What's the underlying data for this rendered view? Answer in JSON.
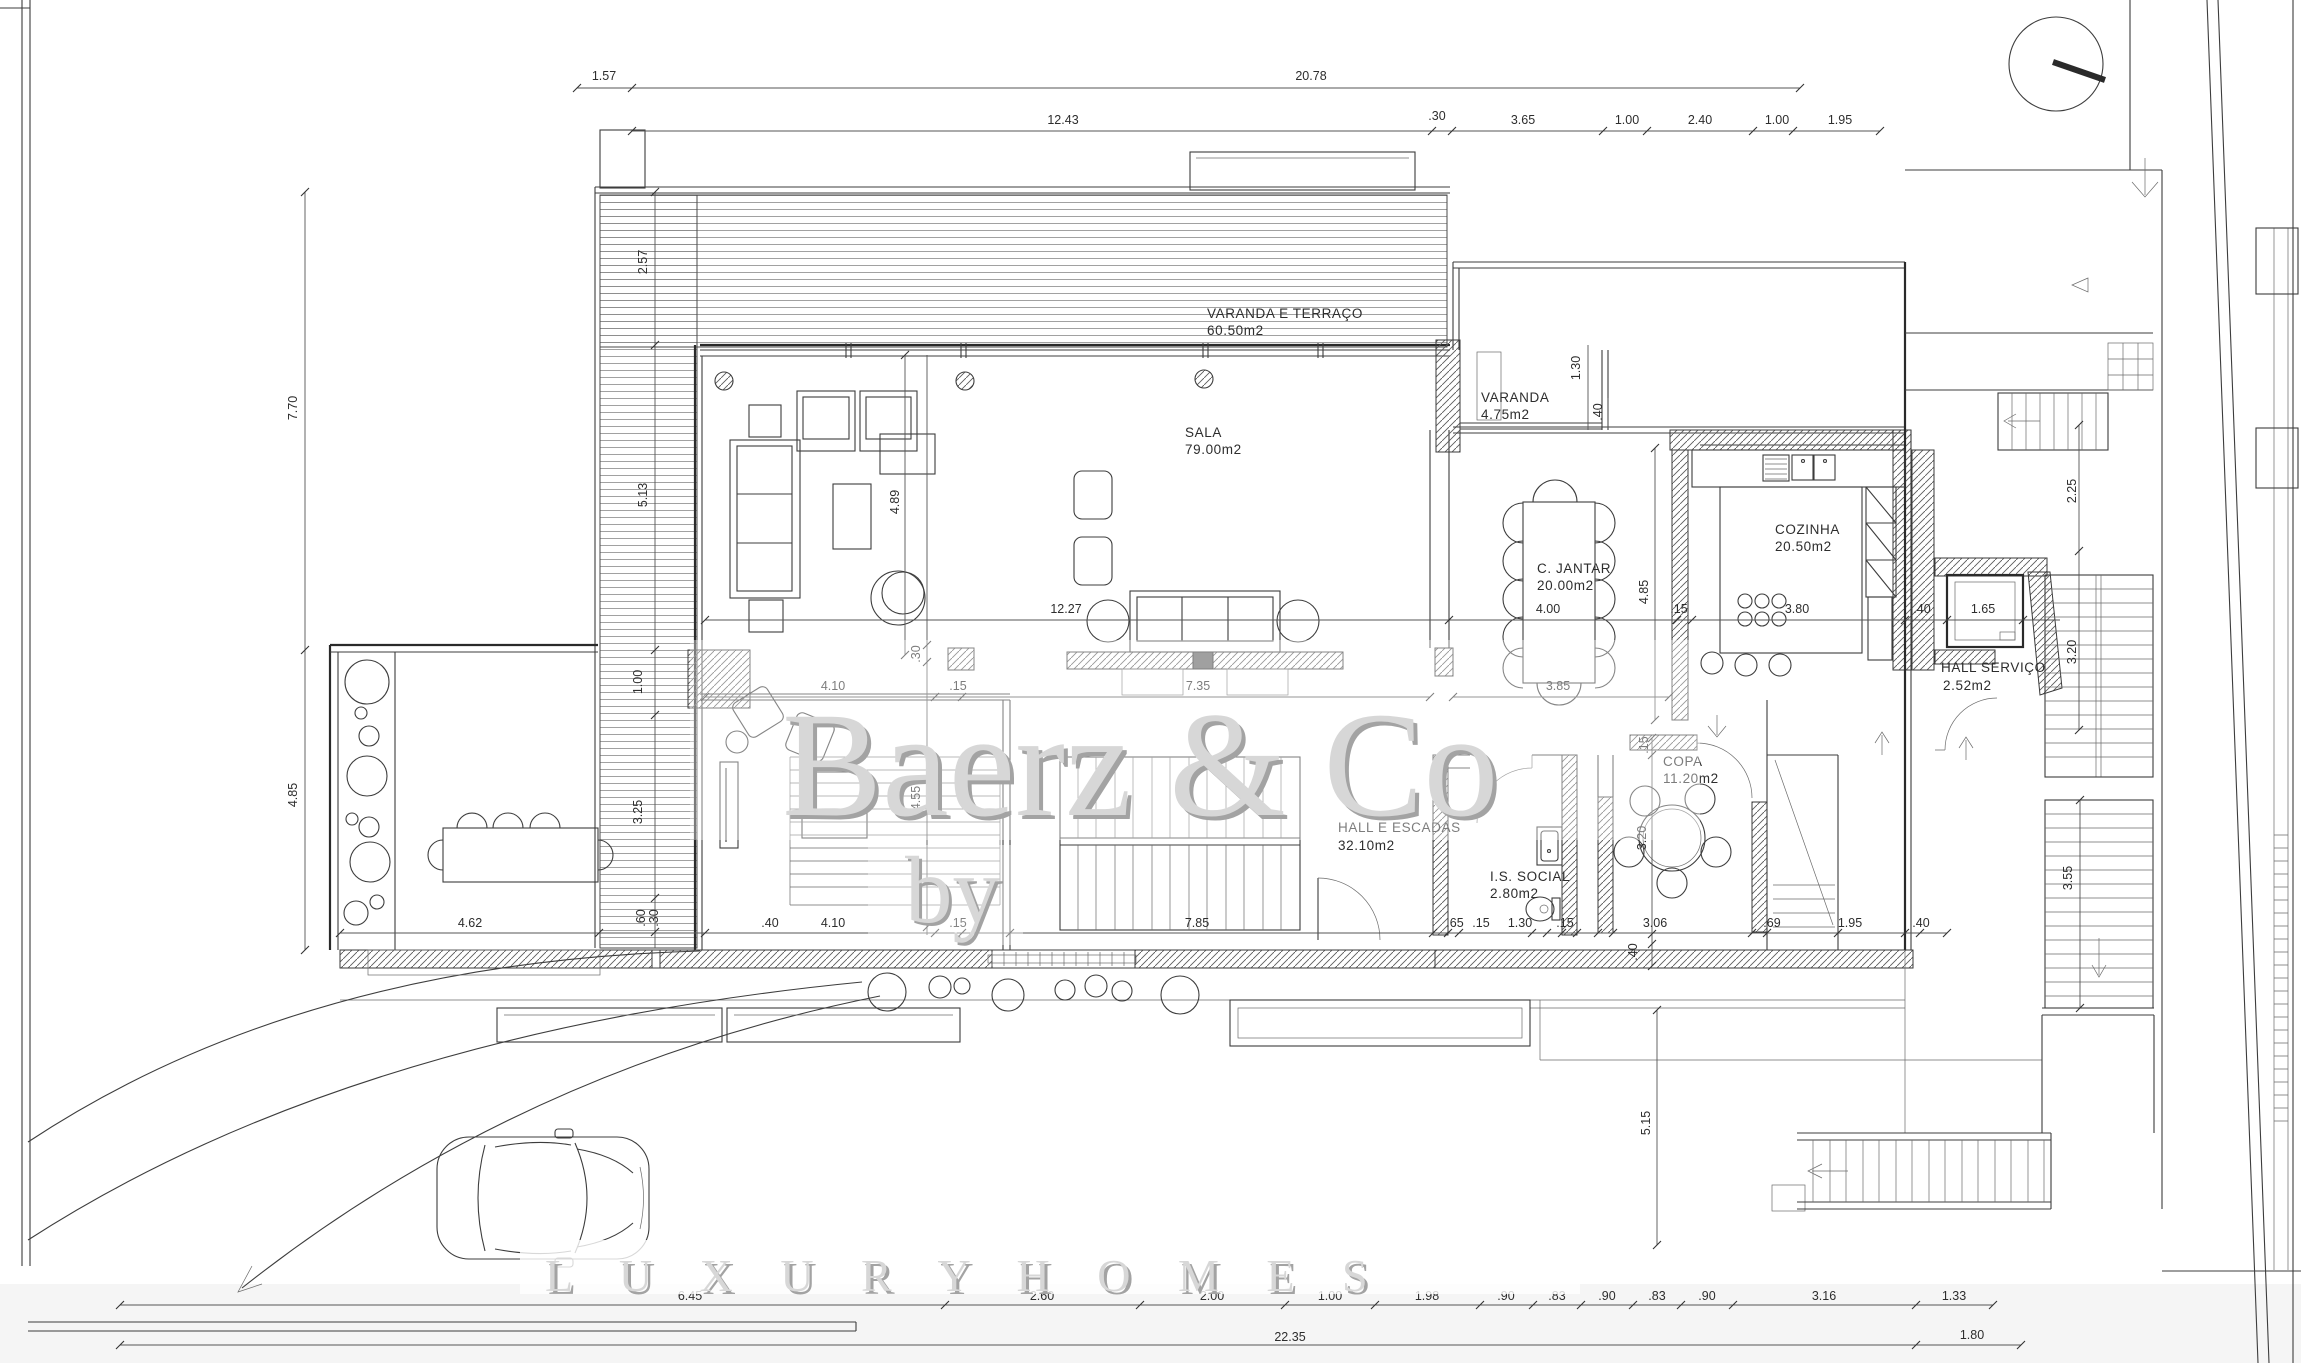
{
  "watermark": {
    "by": "by",
    "brand": "Baerz & Co",
    "tagline": "L U X U R Y   H O M E S"
  },
  "rooms": {
    "terrace": {
      "name": "VARANDA E TERRAÇO",
      "area": "60.50m2"
    },
    "sala": {
      "name": "SALA",
      "area": "79.00m2"
    },
    "varanda": {
      "name": "VARANDA",
      "area": "4.75m2"
    },
    "cozinha": {
      "name": "COZINHA",
      "area": "20.50m2"
    },
    "jantar": {
      "name": "C. JANTAR",
      "area": "20.00m2"
    },
    "copa": {
      "name": "COPA",
      "area": "11.20m2"
    },
    "is_social": {
      "name": "I.S. SOCIAL",
      "area": "2.80m2"
    },
    "hall": {
      "name": "HALL E ESCADAS",
      "area": "32.10m2"
    },
    "hall_servico": {
      "name": "HALL SERVIÇO",
      "area": "2.52m2"
    }
  },
  "dims": [
    "1.57",
    "20.78",
    "12.43",
    ".30",
    "3.65",
    "1.00",
    "2.40",
    "1.00",
    "1.95",
    "7.70",
    "4.85",
    "2.57",
    "5.13",
    "1.00",
    "3.25",
    ".60",
    ".30",
    "4.89",
    ".30",
    "4.55",
    "12.27",
    "4.00",
    ".15",
    "3.80",
    ".40",
    "1.65",
    "4.10",
    ".15",
    "7.35",
    "3.85",
    "4.85",
    "1.30",
    "2.25",
    "3.20",
    "3.20",
    ".15",
    ".40",
    "4.62",
    ".40",
    "4.10",
    ".15",
    "7.85",
    ".65",
    ".15",
    "1.30",
    ".15",
    "3.06",
    ".69",
    "1.95",
    ".40",
    "3.55",
    "5.15",
    "6.45",
    "2.60",
    "2.00",
    "1.00",
    "1.98",
    ".90",
    ".83",
    ".90",
    ".83",
    ".90",
    "3.16",
    "1.33",
    "22.35",
    "1.80",
    ".40"
  ]
}
